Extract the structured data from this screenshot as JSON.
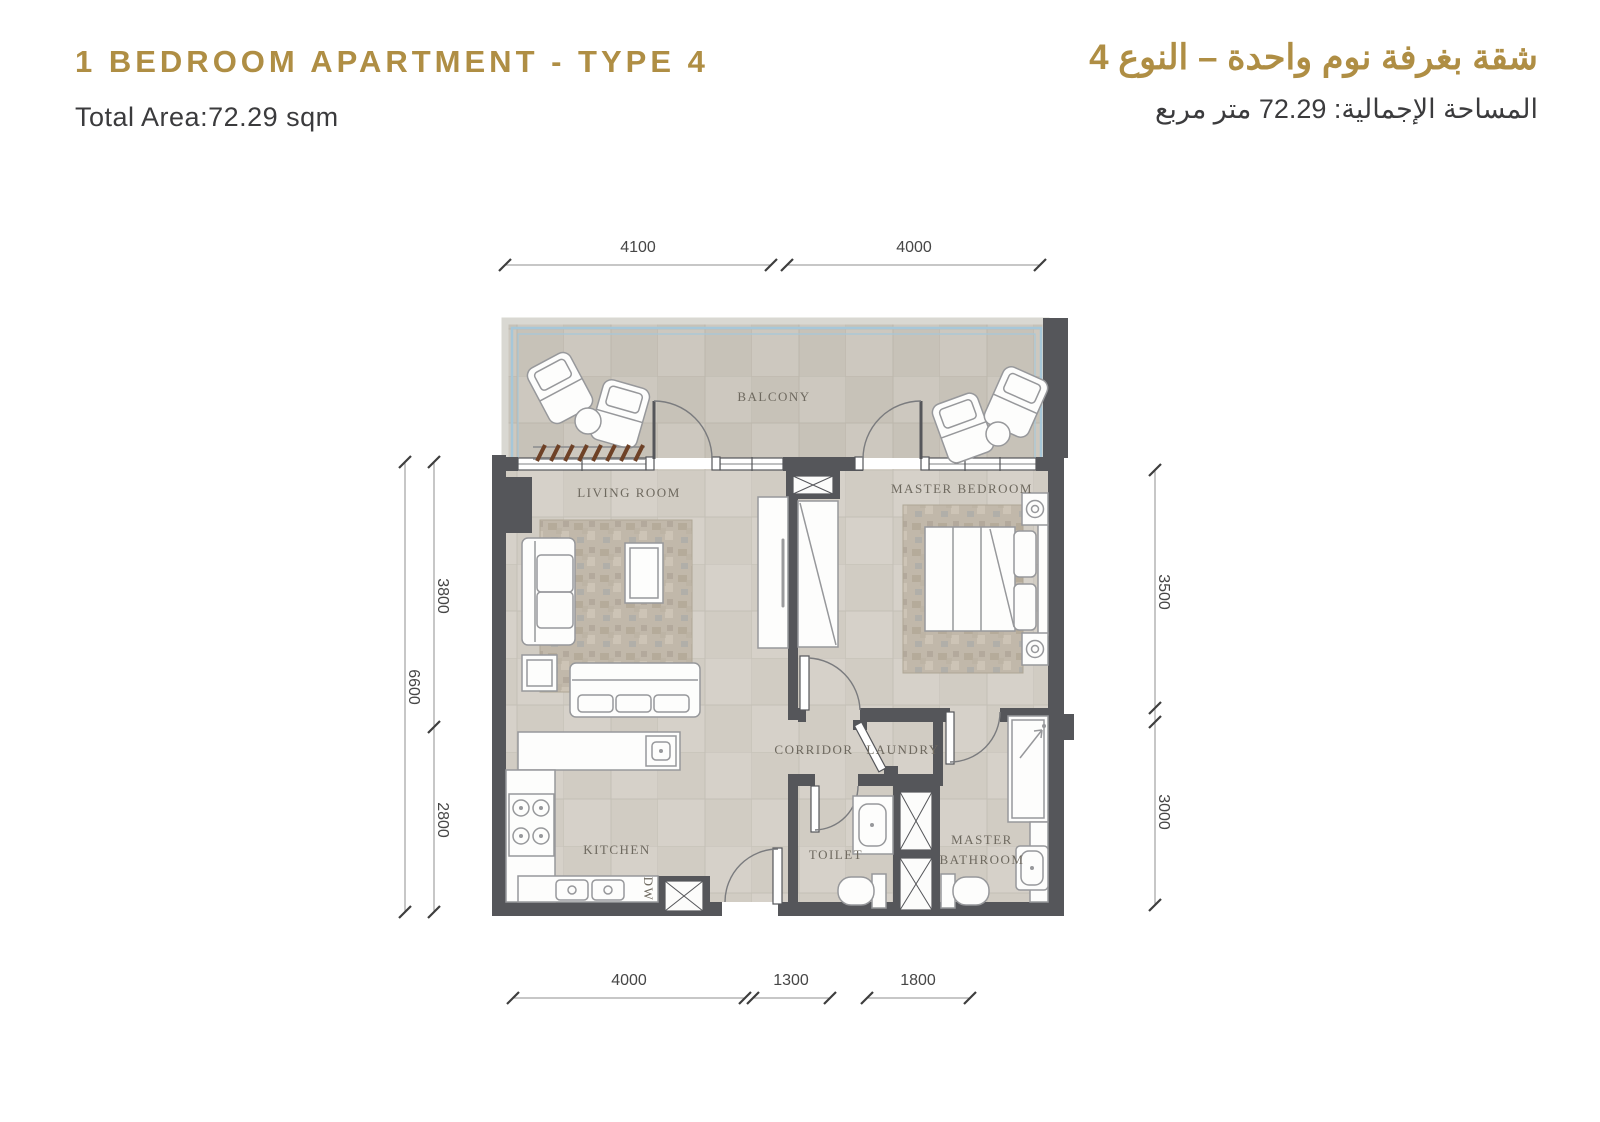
{
  "header": {
    "title_en": "1 BEDROOM APARTMENT - TYPE 4",
    "area_en": "Total Area:72.29 sqm",
    "title_ar": "شقة بغرفة نوم واحدة – النوع 4",
    "area_ar": "المساحة الإجمالية: 72.29 متر مربع"
  },
  "colors": {
    "gold": "#AF8E44",
    "ink": "#3B3B3D",
    "wall": "#55565A",
    "floor": "#D6D1C9",
    "balcony_floor": "#CDC8BF",
    "railing_blue": "#A6C7D9",
    "label": "#6E695F",
    "dimension": "#464646"
  },
  "rooms": {
    "balcony": "BALCONY",
    "living_room": "LIVING ROOM",
    "master_bedroom": "MASTER BEDROOM",
    "corridor": "CORRIDOR",
    "laundry": "LAUNDRY",
    "kitchen": "KITCHEN",
    "toilet": "TOILET",
    "master_bathroom_line1": "MASTER",
    "master_bathroom_line2": "BATHROOM",
    "dw": "DW"
  },
  "dims": {
    "top": [
      "4100",
      "4000"
    ],
    "left_outer": "6600",
    "left_inner": [
      "3800",
      "2800"
    ],
    "right": [
      "3500",
      "3000"
    ],
    "bottom": [
      "4000",
      "1300",
      "1800"
    ]
  }
}
